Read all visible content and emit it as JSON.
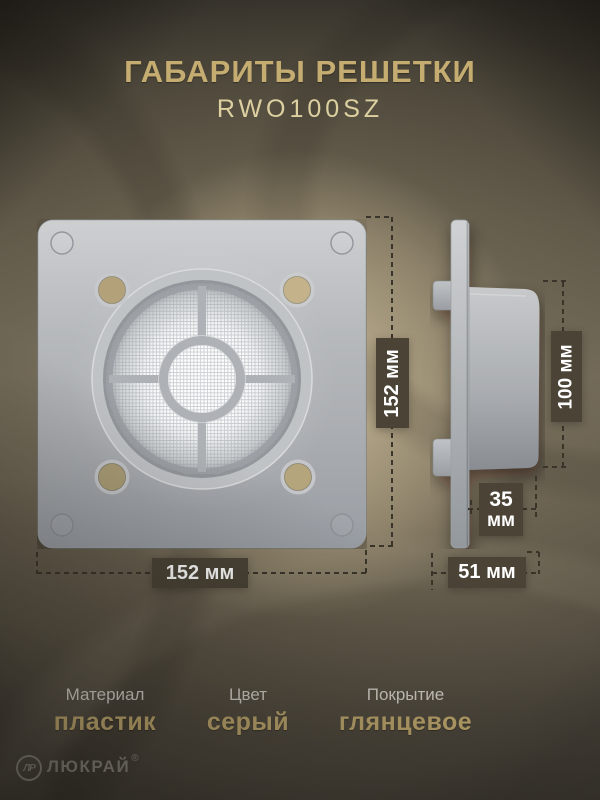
{
  "header": {
    "title": "ГАБАРИТЫ РЕШЕТКИ",
    "model": "RWO100SZ"
  },
  "dimensions": {
    "front_height": "152 мм",
    "front_width": "152 мм",
    "duct_height": "100 мм",
    "duct_depth_value": "35",
    "duct_depth_unit": "мм",
    "total_depth": "51 мм"
  },
  "specs": [
    {
      "label": "Материал",
      "value": "пластик"
    },
    {
      "label": "Цвет",
      "value": "серый"
    },
    {
      "label": "Покрытие",
      "value": "глянцевое"
    }
  ],
  "brand": {
    "monogram": "ЛР",
    "name": "ЛЮКРАЙ",
    "registered": "®"
  },
  "colors": {
    "accent_gold": "#c5ad71",
    "model_gold": "#ddd0a0",
    "label_box_bg": "#4a4336",
    "dash": "#3a352b",
    "plate_gray": "#b4b7ba",
    "hole_beige": "#b7a67e"
  }
}
